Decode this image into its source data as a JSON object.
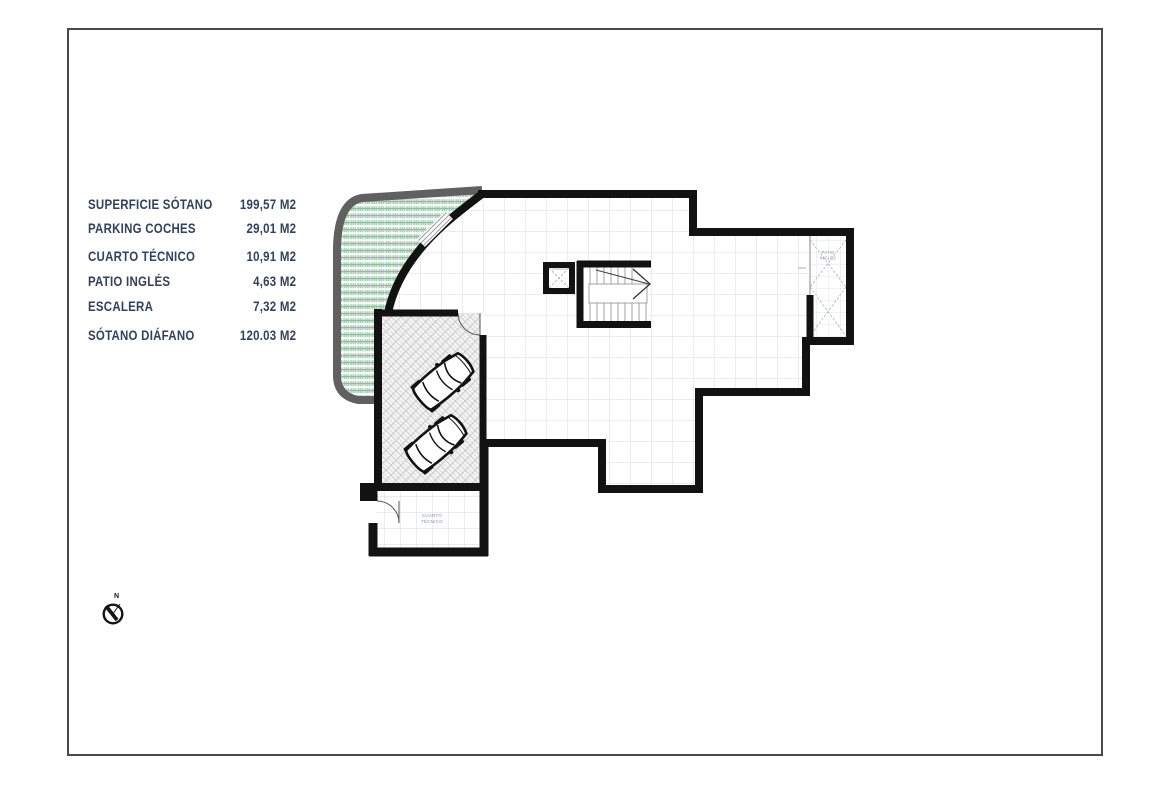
{
  "page": {
    "background": "#ffffff",
    "border_color": "#4a4a4a",
    "title": "Plano de sótano (basement floor plan)"
  },
  "legend": {
    "text_color": "#32415e",
    "rows": [
      {
        "label": "SUPERFICIE SÓTANO",
        "value": "199,57 M2"
      },
      {
        "label": "PARKING COCHES",
        "value": "29,01 M2"
      },
      {
        "label": "CUARTO TÉCNICO",
        "value": "10,91 M2"
      },
      {
        "label": "PATIO INGLÉS",
        "value": "4,63 M2"
      },
      {
        "label": "ESCALERA",
        "value": "7,32 M2"
      },
      {
        "label": "SÓTANO DIÁFANO",
        "value": "120.03 M2"
      }
    ]
  },
  "plan": {
    "room_labels": {
      "patio_line1": "PATIO",
      "patio_line2": "INGLÉS",
      "cuarto_line1": "CUARTO",
      "cuarto_line2": "TÉCNICO",
      "elevator": "ASCENSOR"
    },
    "compass": {
      "label": "N"
    },
    "colors": {
      "wall": "#121212",
      "floor_grid_line": "#d9d9d9",
      "green_hatch": "#9cc7ab",
      "outer_band": "#606060",
      "room_label_text": "#8a93a8"
    }
  }
}
